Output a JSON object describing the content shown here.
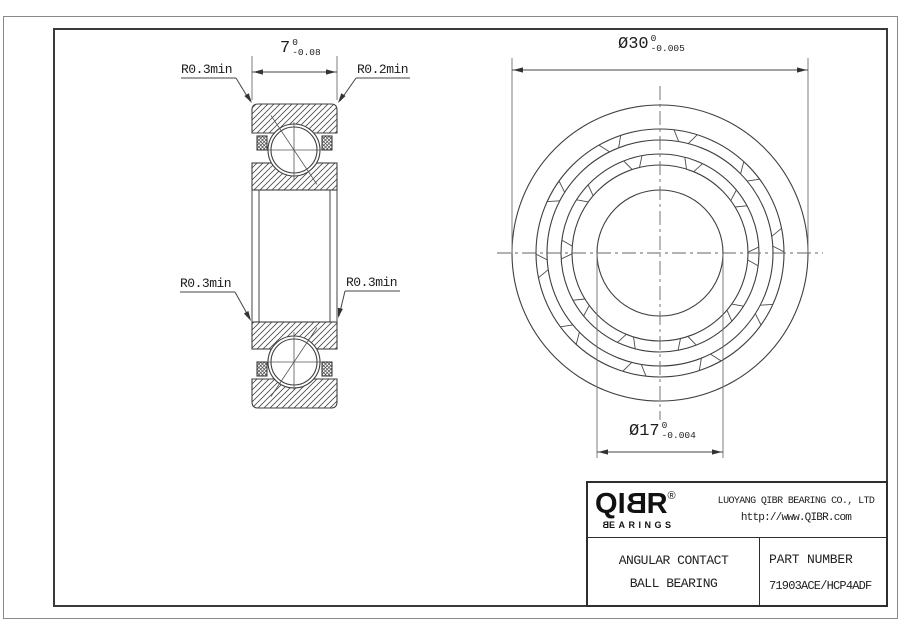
{
  "drawing": {
    "section_labels": {
      "top_left": "R0.3min",
      "top_right": "R0.2min",
      "bottom_left": "R0.3min",
      "bottom_right": "R0.3min"
    },
    "dimensions": {
      "width": {
        "value": "7",
        "tol_upper": "0",
        "tol_lower": "-0.08"
      },
      "outer_diameter": {
        "value": "Ø30",
        "tol_upper": "0",
        "tol_lower": "-0.005"
      },
      "bore_diameter": {
        "value": "Ø17",
        "tol_upper": "0",
        "tol_lower": "-0.004"
      }
    }
  },
  "title_block": {
    "logo": {
      "letters": [
        "Q",
        "I",
        "B",
        "R"
      ],
      "registered": "®",
      "sub_first": "B",
      "sub_rest": "EARINGS"
    },
    "company": "LUOYANG QIBR BEARING CO., LTD",
    "website": "http://www.QIBR.com",
    "product": {
      "line1": "ANGULAR CONTACT",
      "line2": "BALL BEARING"
    },
    "part_number": {
      "label": "PART NUMBER",
      "value": "71903ACE/HCP4ADF"
    }
  }
}
